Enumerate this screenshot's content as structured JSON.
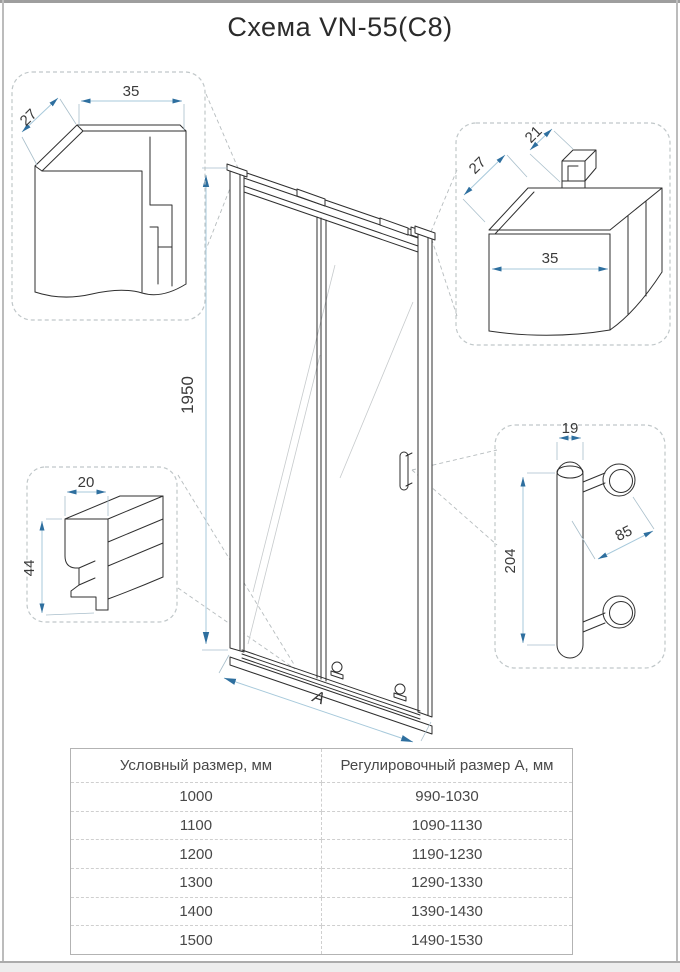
{
  "title": "Схема VN-55(C8)",
  "dims": {
    "top_left_width": "35",
    "top_left_depth": "27",
    "top_right_depth": "27",
    "top_right_top": "21",
    "top_right_width": "35",
    "bottom_left_width": "20",
    "bottom_left_height": "44",
    "handle_width": "19",
    "handle_length": "204",
    "handle_spacing": "85",
    "door_height": "1950",
    "door_width_label": "A"
  },
  "table": {
    "headers": [
      "Условный размер, мм",
      "Регулировочный размер А, мм"
    ],
    "rows": [
      [
        "1000",
        "990-1030"
      ],
      [
        "1100",
        "1090-1130"
      ],
      [
        "1200",
        "1190-1230"
      ],
      [
        "1300",
        "1290-1330"
      ],
      [
        "1400",
        "1390-1430"
      ],
      [
        "1500",
        "1490-1530"
      ]
    ]
  },
  "colors": {
    "dimension_line": "#a7c9db",
    "dimension_arrow": "#2e6f9f",
    "line_art": "#2f2f2f",
    "table_border": "#b3b3b3"
  }
}
